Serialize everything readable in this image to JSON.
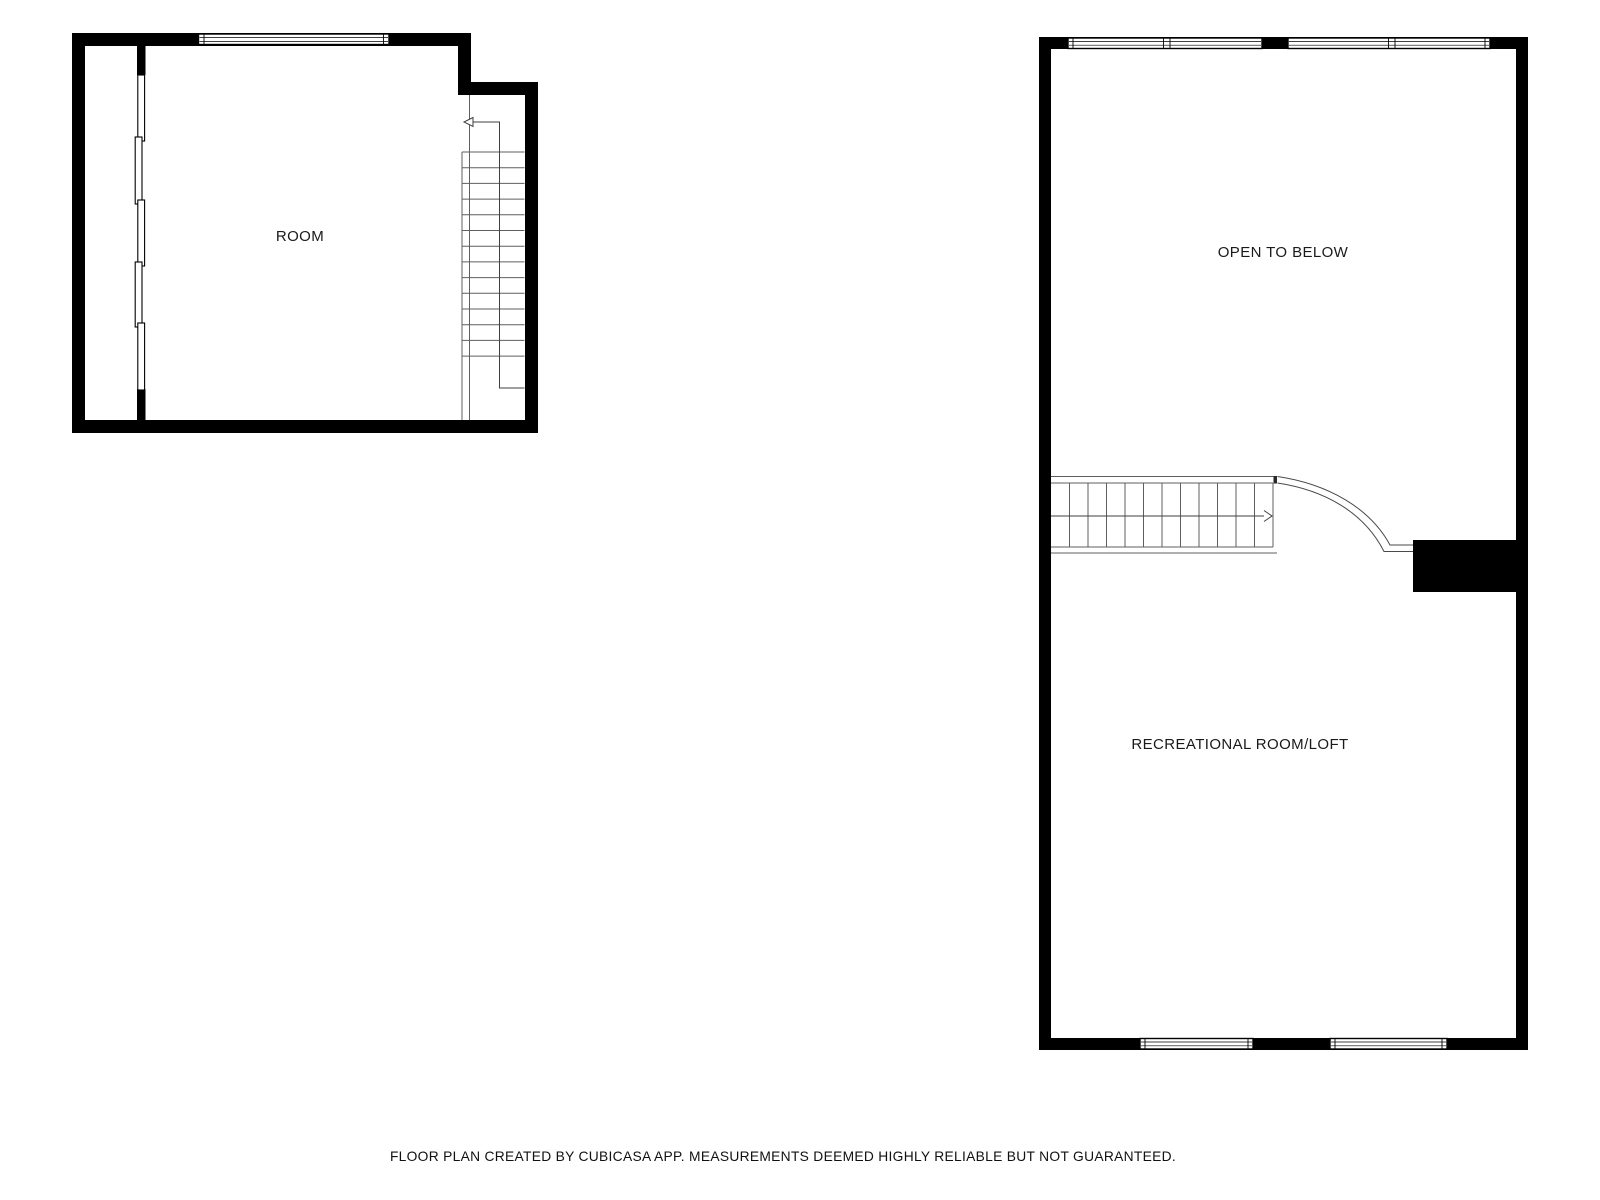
{
  "colors": {
    "wall": "#000000",
    "background": "#ffffff",
    "stair_line": "#5f5f5f",
    "walk_line": "#3f3f3f",
    "text": "#1a1a1a"
  },
  "left_plan": {
    "room_label": "ROOM"
  },
  "right_plan": {
    "upper_label": "OPEN TO BELOW",
    "lower_label": "RECREATIONAL ROOM/LOFT"
  },
  "footer": {
    "disclaimer": "FLOOR PLAN CREATED BY CUBICASA APP. MEASUREMENTS DEEMED HIGHLY RELIABLE BUT NOT GUARANTEED."
  }
}
